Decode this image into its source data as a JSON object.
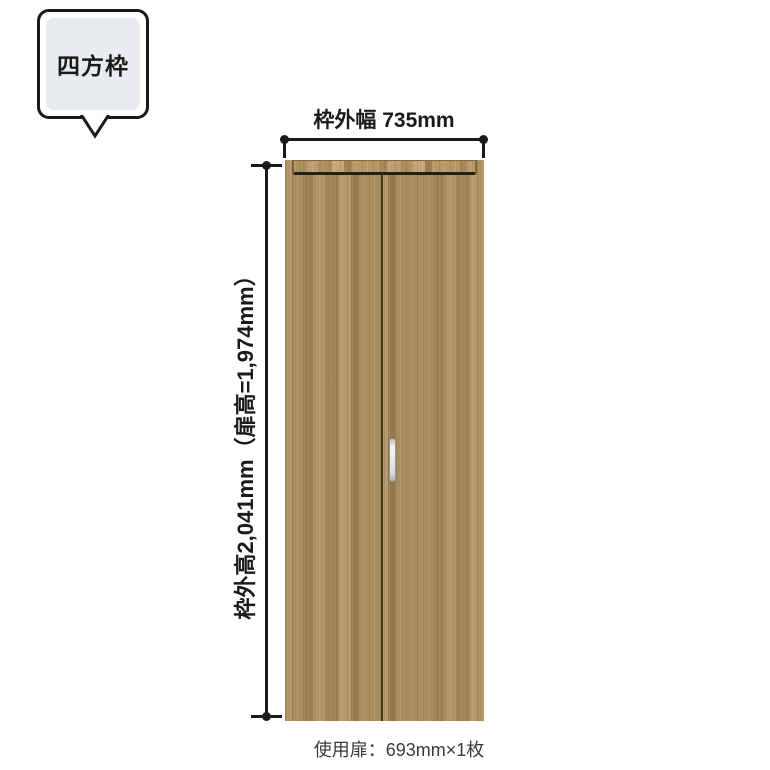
{
  "callout": {
    "label": "四方枠"
  },
  "dimensions": {
    "width_label": "枠外幅 735mm",
    "height_label": "枠外高2,041mm（扉高=1,974mm）",
    "frame_outer_width_mm": 735,
    "frame_outer_height_mm": 2041,
    "door_height_mm": 1974
  },
  "caption": "使用扉：693mm×1枚",
  "door": {
    "description": "wood-grain folding door, two panels, silver handle right of center split",
    "used_door_width_mm": 693,
    "used_door_count": 1,
    "wood_base_color": "#a5885a",
    "handle_color": "#e9e9e9"
  },
  "colors": {
    "background": "#ffffff",
    "line": "#1a1a1a",
    "callout_fill": "#e8ecef",
    "caption_text": "#3a3a3a"
  }
}
